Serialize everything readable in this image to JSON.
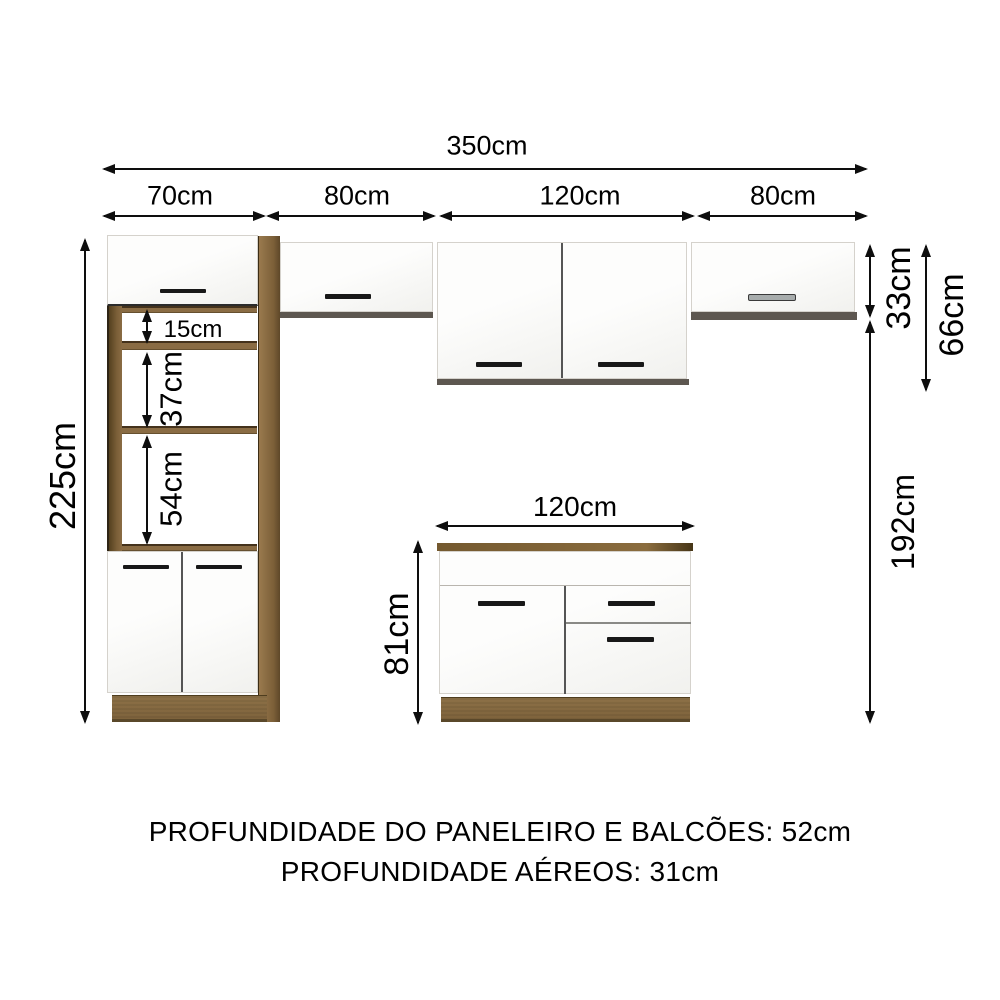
{
  "diagram": {
    "total_width": "350cm",
    "segments": [
      "70cm",
      "80cm",
      "120cm",
      "80cm"
    ],
    "tower_height": "225cm",
    "tower_gaps": [
      "15cm",
      "37cm",
      "54cm"
    ],
    "wall_cabinet_height": "33cm",
    "wall_tall_cabinet_height": "66cm",
    "wall_to_floor_height": "192cm",
    "base_cabinet_width": "120cm",
    "base_cabinet_height": "81cm"
  },
  "footer": {
    "line1": "PROFUNDIDADE DO PANELEIRO E BALCÕES: 52cm",
    "line2": "PROFUNDIDADE AÉREOS: 31cm"
  },
  "colors": {
    "wood": "#8a6c44",
    "wood_dark": "#6a5132",
    "wood_light": "#97784c",
    "shadow_strip": "#5d5750",
    "handle_black": "#181818",
    "handle_gray": "#a7acac",
    "dimension_line": "#0e0e0e"
  }
}
